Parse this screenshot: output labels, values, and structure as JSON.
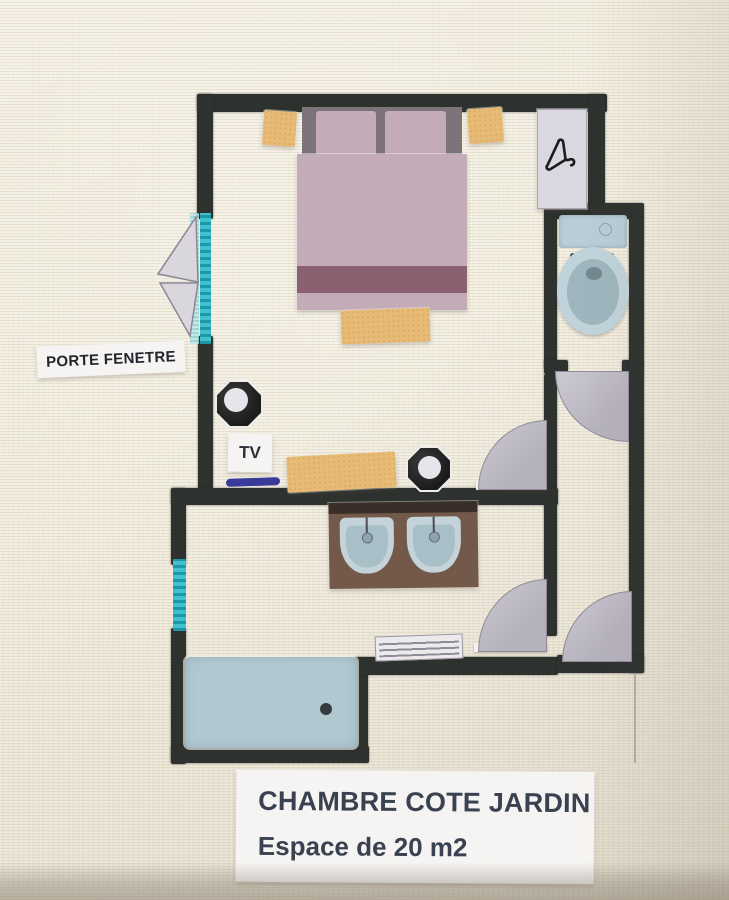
{
  "caption": {
    "line1": "CHAMBRE COTE JARDIN",
    "line2": "Espace de 20 m2"
  },
  "labels": {
    "porte_fenetre": "PORTE FENETRE",
    "tv": "TV"
  },
  "icons": {
    "hanger": "hanger-icon",
    "toilet": "toilet-icon",
    "sink": "sink-icon",
    "shower": "shower-icon",
    "door_swing": "door-swing-icon",
    "window": "window-strip-icon",
    "stool": "octagon-stool-icon"
  },
  "colors": {
    "background_paper": "#f0ebdb",
    "wall": "#2e322f",
    "window_teal": "#3fc2cc",
    "linen_mauve": "#c3acb8",
    "duvet_stripe": "#8b6070",
    "headboard_gray": "#7d737b",
    "wood_tan": "#e7bb75",
    "fixture_blue": "#c0d3da",
    "counter_brown": "#73594a",
    "door_gray": "#bdb9c3",
    "tv_line_blue": "#3a3a9a",
    "caption_text": "#3a4252"
  }
}
